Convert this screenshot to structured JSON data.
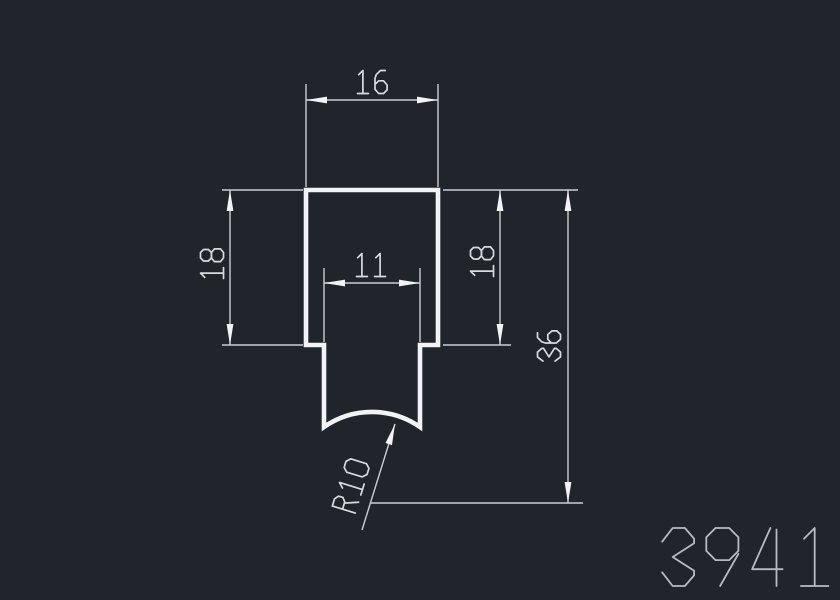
{
  "drawing": {
    "canvas": {
      "width": 840,
      "height": 600,
      "background": "#20252b"
    },
    "colors": {
      "profile_stroke": "#f1f3f5",
      "dimension_line": "#c9ced3",
      "dimension_text": "#d8dbde",
      "part_number": "#b7bcc2"
    },
    "profile": {
      "description": "extrusion-cross-section",
      "outline": {
        "outer_left": 306,
        "outer_right": 438,
        "outer_top": 190,
        "step_y": 345,
        "stem_left": 324,
        "stem_right": 420,
        "stem_bottom": 427,
        "bottom_arc_radius": 84
      },
      "stroke_width": 4.6
    },
    "dimensions": [
      {
        "id": "width-16",
        "label": "16",
        "value": 16,
        "orientation": "horizontal",
        "dim_line": {
          "x1": 306,
          "y1": 100,
          "x2": 438,
          "y2": 100
        },
        "extensions": [
          {
            "x1": 306,
            "y1": 84,
            "x2": 306,
            "y2": 187
          },
          {
            "x1": 438,
            "y1": 84,
            "x2": 438,
            "y2": 187
          }
        ],
        "text_pos": [
          372,
          82
        ],
        "text_rotation": 0,
        "text_height": 23
      },
      {
        "id": "height-18-left",
        "label": "18",
        "value": 18,
        "orientation": "vertical",
        "dim_line": {
          "x1": 230,
          "y1": 190,
          "x2": 230,
          "y2": 345
        },
        "extensions": [
          {
            "x1": 222,
            "y1": 190,
            "x2": 303,
            "y2": 190
          },
          {
            "x1": 222,
            "y1": 345,
            "x2": 303,
            "y2": 345
          }
        ],
        "text_pos": [
          212,
          264
        ],
        "text_rotation": -90,
        "text_height": 23
      },
      {
        "id": "width-11",
        "label": "11",
        "value": 11,
        "orientation": "horizontal",
        "dim_line": {
          "x1": 324,
          "y1": 283,
          "x2": 420,
          "y2": 283
        },
        "extensions": [
          {
            "x1": 324,
            "y1": 268,
            "x2": 324,
            "y2": 342
          },
          {
            "x1": 420,
            "y1": 268,
            "x2": 420,
            "y2": 342
          }
        ],
        "text_pos": [
          371,
          265
        ],
        "text_rotation": 0,
        "text_height": 23
      },
      {
        "id": "height-18-right",
        "label": "18",
        "value": 18,
        "orientation": "vertical",
        "dim_line": {
          "x1": 500,
          "y1": 190,
          "x2": 500,
          "y2": 345
        },
        "extensions": [
          {
            "x1": 443,
            "y1": 190,
            "x2": 511,
            "y2": 190
          },
          {
            "x1": 443,
            "y1": 345,
            "x2": 511,
            "y2": 345
          }
        ],
        "text_pos": [
          482,
          262
        ],
        "text_rotation": -90,
        "text_height": 23
      },
      {
        "id": "height-36",
        "label": "36",
        "value": 36,
        "orientation": "vertical",
        "dim_line": {
          "x1": 568,
          "y1": 190,
          "x2": 568,
          "y2": 503
        },
        "extensions": [
          {
            "x1": 511,
            "y1": 190,
            "x2": 578,
            "y2": 190
          },
          {
            "x1": 371,
            "y1": 503,
            "x2": 583,
            "y2": 503
          }
        ],
        "text_pos": [
          549,
          346
        ],
        "text_rotation": -90,
        "text_height": 23
      },
      {
        "id": "radius-r10",
        "label": "R10",
        "value": 10,
        "orientation": "leader",
        "leader": {
          "tail": [
            362,
            530
          ],
          "tip": [
            395,
            424
          ]
        },
        "text_pos": [
          351,
          486
        ],
        "text_rotation": -73,
        "text_height": 24
      }
    ],
    "part_number": {
      "text": "3941",
      "center": [
        746,
        557
      ],
      "text_height": 58
    }
  }
}
